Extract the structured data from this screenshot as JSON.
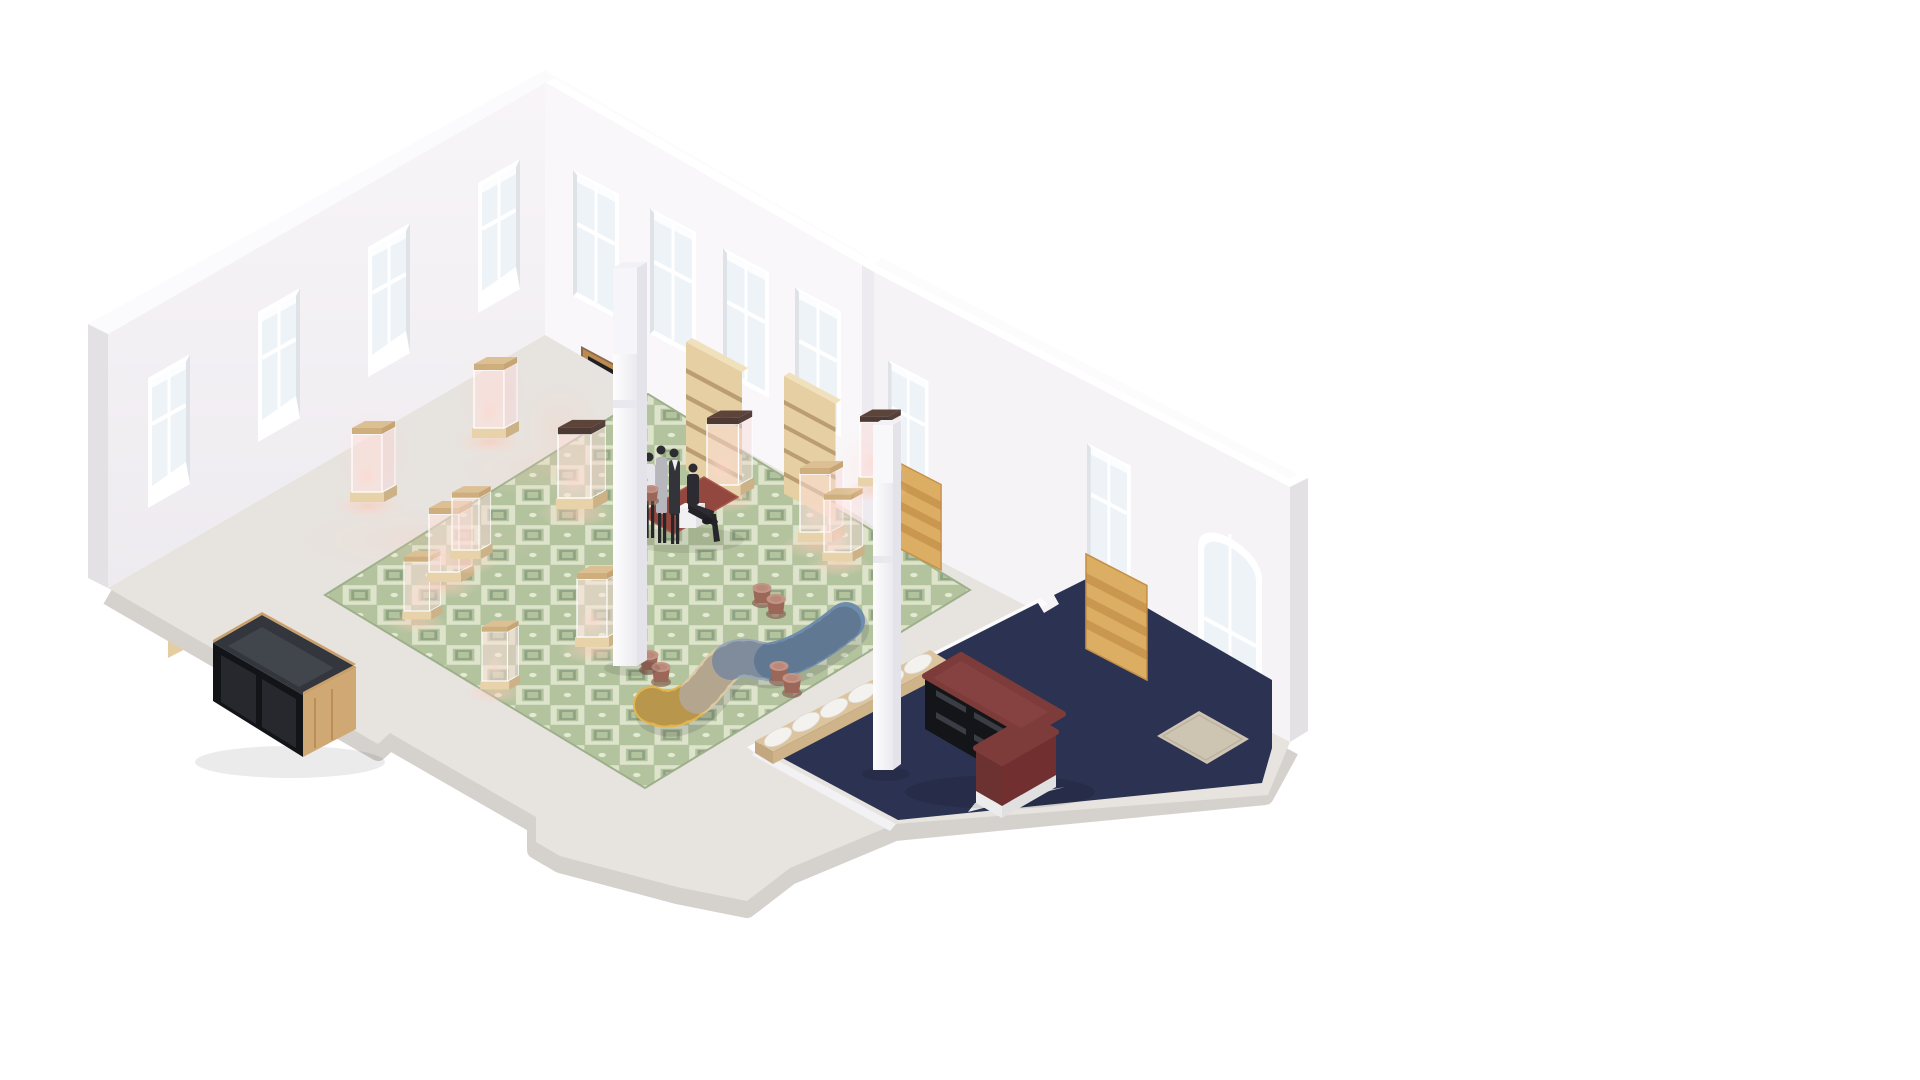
{
  "scene": {
    "description": "Isometric cutaway rendering of an L-shaped gallery interior with display vitrines, mannequins, a serpentine sofa and a navy reception platform",
    "view": "isometric cutaway 3D architectural render",
    "background": "#ffffff"
  },
  "room": {
    "walls": "white plaster cutaway walls",
    "left_wall_windows": 4,
    "back_wall_windows": 4,
    "right_wing_windows": 2,
    "arched_glass_door": 1,
    "wood_entry_door_with_dark_transom": 1,
    "recessed_wood_shelf_niches": 3,
    "freestanding_wood_bookcases": 2,
    "leaning_wood_slat_panels": 2,
    "columns": 2
  },
  "furniture": {
    "glass_display_vitrines": 12,
    "vitrine_lighting": "warm pink glow",
    "mannequins": 4,
    "mannequin_platform": "low maroon plinth with white cube seat",
    "serpentine_sofa_segments": [
      "mustard yellow",
      "beige",
      "gray blue",
      "steel blue"
    ],
    "copper_side_stools": 8,
    "daybed_bench": "light wood base with white cushions",
    "reception_desk": "burgundy L-shaped desk with black open shelving and white plinth",
    "storage_counter": "oak counter with smoked-glass sliding front",
    "doormat": "beige rectangular mat on navy floor"
  },
  "colors": {
    "background": "#ffffff",
    "wall_face": "#f3f0f4",
    "wall_back": "#f9f7f9",
    "wall_cut": "#e4e1e5",
    "wall_top": "#fbfafc",
    "wall_seam": "#eeebf0",
    "slab": "#e7e3df",
    "slab_edge": "#d5d1cd",
    "carpet_base": "#b3c39e",
    "carpet_motif": "#e4ead3",
    "carpet_motif2": "#8fa383",
    "navy": "#2c3352",
    "white_band": "#fbfbfd",
    "riser": "#f2f1f3",
    "glow": "#ffc7b6",
    "wood_light": "#e6cfa2",
    "wood_mid": "#cfa873",
    "wood_door": "#bd8a50",
    "wood_slat": "#dcae64",
    "counter_black": "#131417",
    "counter_top": "#33363c",
    "desk_maroon": "#7d3c3a",
    "desk_dark": "#6b3231",
    "sofa_yellow": "#e2b54d",
    "sofa_beige": "#dcc9a6",
    "sofa_gray": "#97a7b8",
    "sofa_blue": "#6e8cab",
    "stool_copper": "#c39486",
    "stool_dark": "#9a6758",
    "bench_wood": "#dcc49e",
    "cushion": "#f4f2ee",
    "mat": "#cec4b2",
    "mannequin_dark": "#33333a",
    "mannequin_light": "#e7e7eb",
    "mannequin_gray": "#b6b6bc",
    "platform_maroon": "#93483f",
    "column_side": "#e4e3e9"
  }
}
